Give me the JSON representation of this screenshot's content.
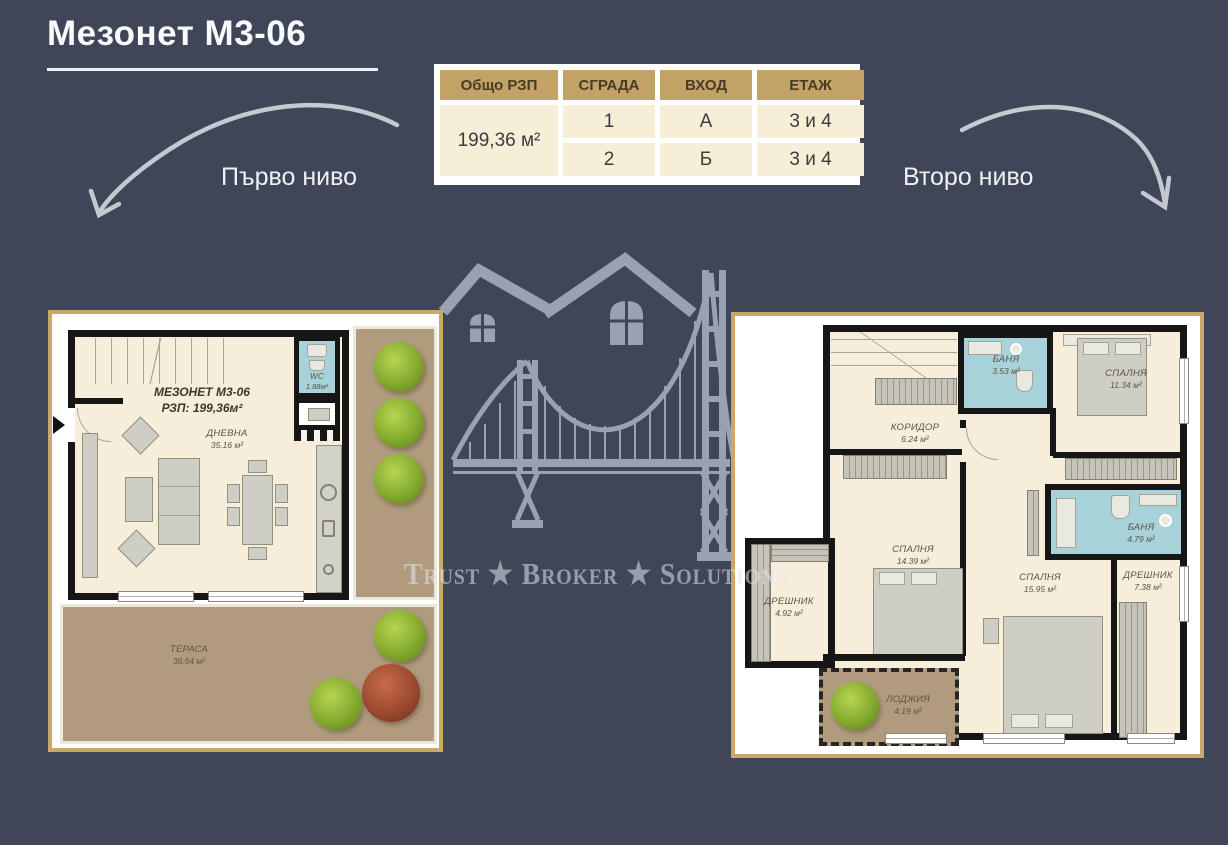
{
  "page": {
    "title": "Мезонет М3-06"
  },
  "table": {
    "headers": [
      "Общо РЗП",
      "СГРАДА",
      "ВХОД",
      "ЕТАЖ"
    ],
    "total_area": "199,36 м²",
    "rows": [
      {
        "building": "1",
        "entrance": "А",
        "floor": "3 и 4"
      },
      {
        "building": "2",
        "entrance": "Б",
        "floor": "3 и 4"
      }
    ]
  },
  "levels": {
    "first": "Първо ниво",
    "second": "Второ ниво"
  },
  "watermark": {
    "brand": "Trust ★ Broker ★ Solutions"
  },
  "plan1": {
    "title": "МЕЗОНЕТ М3-06",
    "rzp": "РЗП: 199,36м²",
    "living": {
      "name": "ДНЕВНА",
      "area": "35.16 м²"
    },
    "wc": {
      "name": "WC",
      "area": "1.88м²"
    },
    "terrace": {
      "name": "ТЕРАСА",
      "area": "36.94 м²"
    }
  },
  "plan2": {
    "corridor": {
      "name": "КОРИДОР",
      "area": "6.24 м²"
    },
    "bath1": {
      "name": "БАНЯ",
      "area": "3.53 м²"
    },
    "bedroom1": {
      "name": "СПАЛНЯ",
      "area": "11.34 м²"
    },
    "bedroom2": {
      "name": "СПАЛНЯ",
      "area": "14.39 м²"
    },
    "closet1": {
      "name": "ДРЕШНИК",
      "area": "4.92 м²"
    },
    "bath2": {
      "name": "БАНЯ",
      "area": "4.79 м²"
    },
    "bedroom3": {
      "name": "СПАЛНЯ",
      "area": "15.95 м²"
    },
    "closet2": {
      "name": "ДРЕШНИК",
      "area": "7.38 м²"
    },
    "loggia": {
      "name": "ЛОДЖИЯ",
      "area": "4.19 м²"
    }
  },
  "colors": {
    "background": "#3e4657",
    "frame_gold": "#c9a96a",
    "table_header": "#c2a267",
    "table_cell": "#f6eed7",
    "room_fill": "#f6eedb",
    "bath_fill": "#a7d2da",
    "terrace_fill": "#b19b7e",
    "wall": "#161616",
    "watermark_gray": "#99a2b1"
  }
}
